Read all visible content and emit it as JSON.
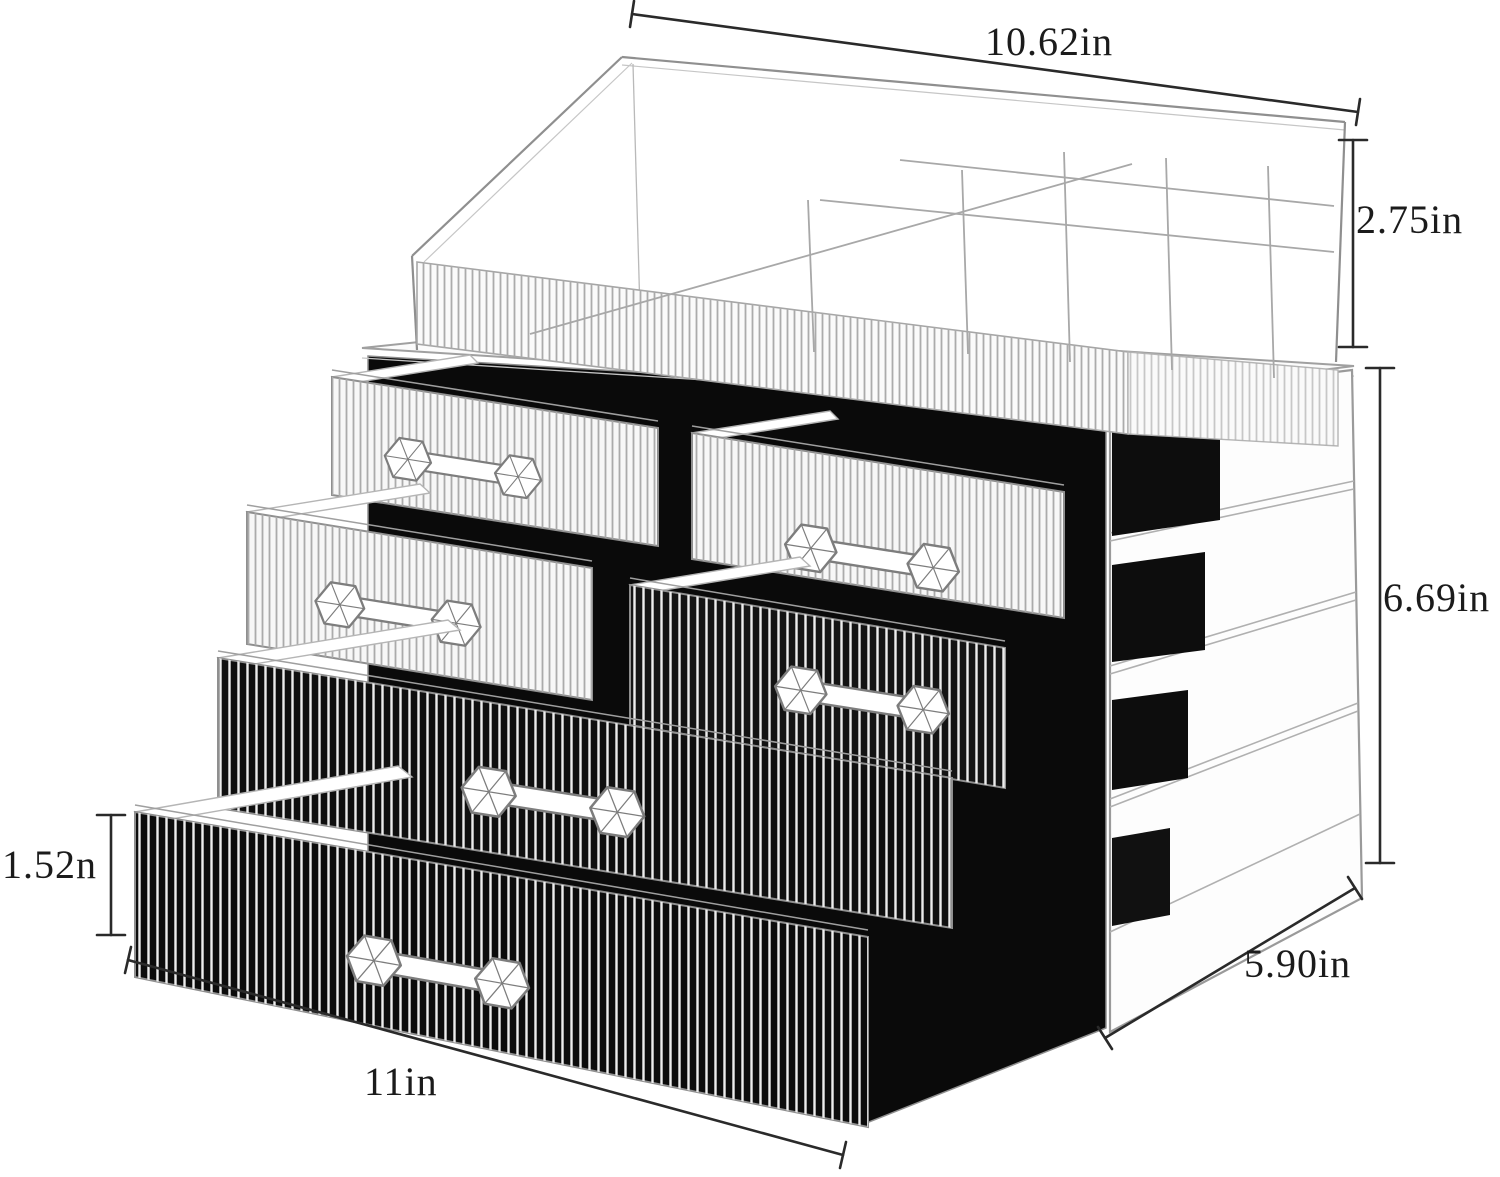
{
  "image_type": "product-dimension-diagram",
  "product": "clear acrylic cosmetic organizer with drawers",
  "colors": {
    "background": "#ffffff",
    "dimension_line": "#2a2a2a",
    "sketch_line": "#9a9a9a",
    "drawer_interior": "#0a0a0a"
  },
  "dimensions": {
    "top_width": {
      "label": "10.62in"
    },
    "tray_height": {
      "label": "2.75in"
    },
    "body_height": {
      "label": "6.69in"
    },
    "drawer_height": {
      "label": "1.52n"
    },
    "depth": {
      "label": "5.90in"
    },
    "bottom_width": {
      "label": "11in"
    }
  }
}
